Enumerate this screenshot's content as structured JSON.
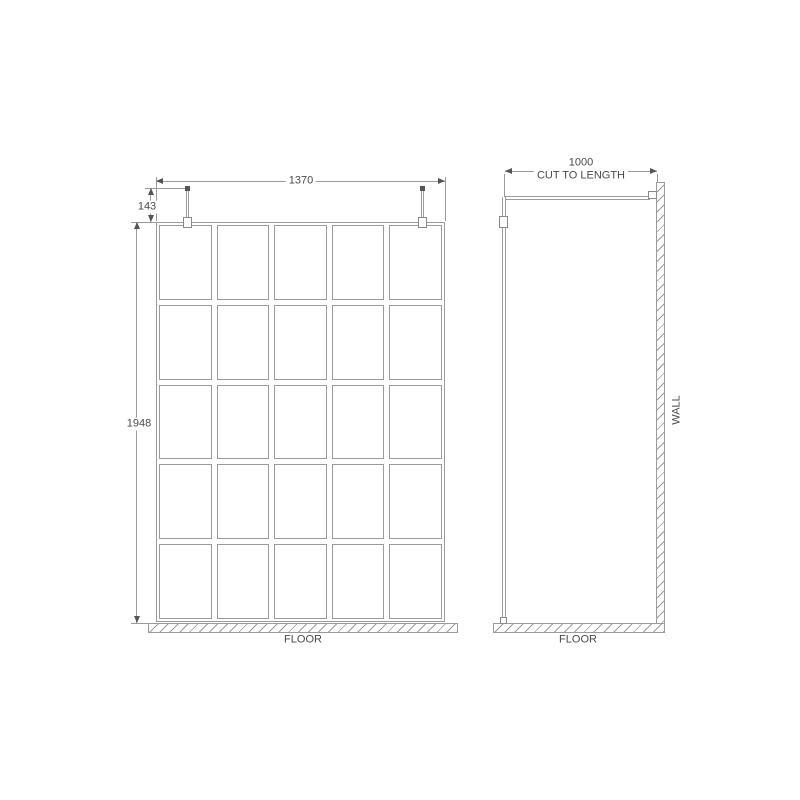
{
  "front": {
    "width_dim": "1370",
    "bracket_dim": "143",
    "height_dim": "1948",
    "floor_label": "FLOOR",
    "grid_rows": 5,
    "grid_cols": 5
  },
  "side": {
    "length_dim": "1000",
    "length_note": "CUT TO LENGTH",
    "wall_label": "WALL",
    "floor_label": "FLOOR"
  },
  "colors": {
    "line": "#9b9b9b",
    "text": "#4a4a4a",
    "accent": "#555555"
  }
}
